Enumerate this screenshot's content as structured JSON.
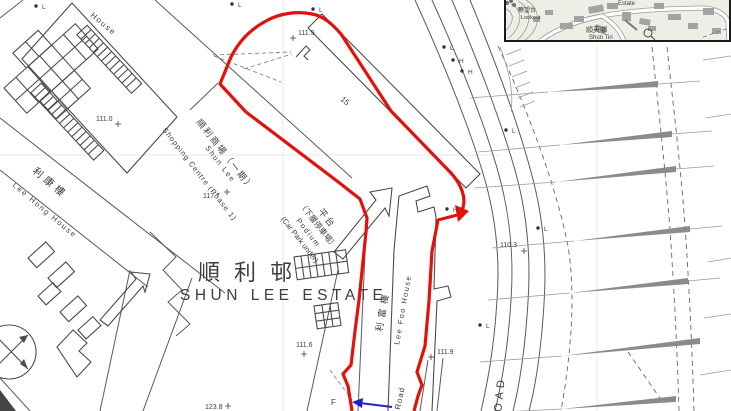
{
  "map": {
    "estate_cn": "順利邨",
    "estate_en": "SHUN LEE ESTATE",
    "lee_hong_cn": "利康樓",
    "lee_hong_en": "Lee Hong House",
    "shopping_cn": "順利商場（一期）",
    "shopping_en_1": "Shun Lee",
    "shopping_en_2": "Shopping Centre (Phase 1)",
    "podium_cn_1": "平台",
    "podium_cn_2": "（下層停車場）",
    "podium_en_1": "Podium",
    "podium_en_2": "(Car Park under)",
    "lee_foo_cn": "利富樓",
    "lee_foo_en": "Lee Foo House",
    "house_partial": "House",
    "building_no": "15",
    "road_main": "ROAD",
    "road_partial": "Road",
    "label_f": "F"
  },
  "elevations": [
    {
      "label": "111.0",
      "x": 96,
      "y": 121,
      "cx": 118,
      "cy": 124
    },
    {
      "label": "111.5",
      "x": 298,
      "y": 35,
      "cx": 293,
      "cy": 38
    },
    {
      "label": "117.7",
      "x": 203,
      "y": 198,
      "cx": 227,
      "cy": 192
    },
    {
      "label": "110.3",
      "x": 500,
      "y": 247,
      "cx": 524,
      "cy": 251
    },
    {
      "label": "111.9",
      "x": 437,
      "y": 354,
      "cx": 431,
      "cy": 357
    },
    {
      "label": "111.6",
      "x": 296,
      "y": 347,
      "cx": 304,
      "cy": 354
    },
    {
      "label": "123.8",
      "x": 205,
      "y": 409,
      "cx": 228,
      "cy": 406
    }
  ],
  "markers": [
    {
      "t": "L",
      "x": 42,
      "y": 9
    },
    {
      "t": "L",
      "x": 238,
      "y": 7
    },
    {
      "t": "L",
      "x": 319,
      "y": 12
    },
    {
      "t": "L",
      "x": 450,
      "y": 50
    },
    {
      "t": "H",
      "x": 459,
      "y": 63
    },
    {
      "t": "H",
      "x": 468,
      "y": 74
    },
    {
      "t": "H",
      "x": 453,
      "y": 212
    },
    {
      "t": "L",
      "x": 512,
      "y": 133
    },
    {
      "t": "L",
      "x": 544,
      "y": 231
    },
    {
      "t": "L",
      "x": 486,
      "y": 328
    }
  ],
  "inset": {
    "lookout_cn": "瞭望台",
    "lookout_en": "Lookout",
    "estate_en": "Estate",
    "shun_tin_cn": "順天邨",
    "shun_tin_en": "Shun Tin"
  },
  "colors": {
    "boundary_red": "#e31109",
    "arrow_blue": "#2222c4",
    "line_gray": "#4f4f4f",
    "slope_gray": "#8b8b8b",
    "inset_bg": "#efeee6"
  }
}
